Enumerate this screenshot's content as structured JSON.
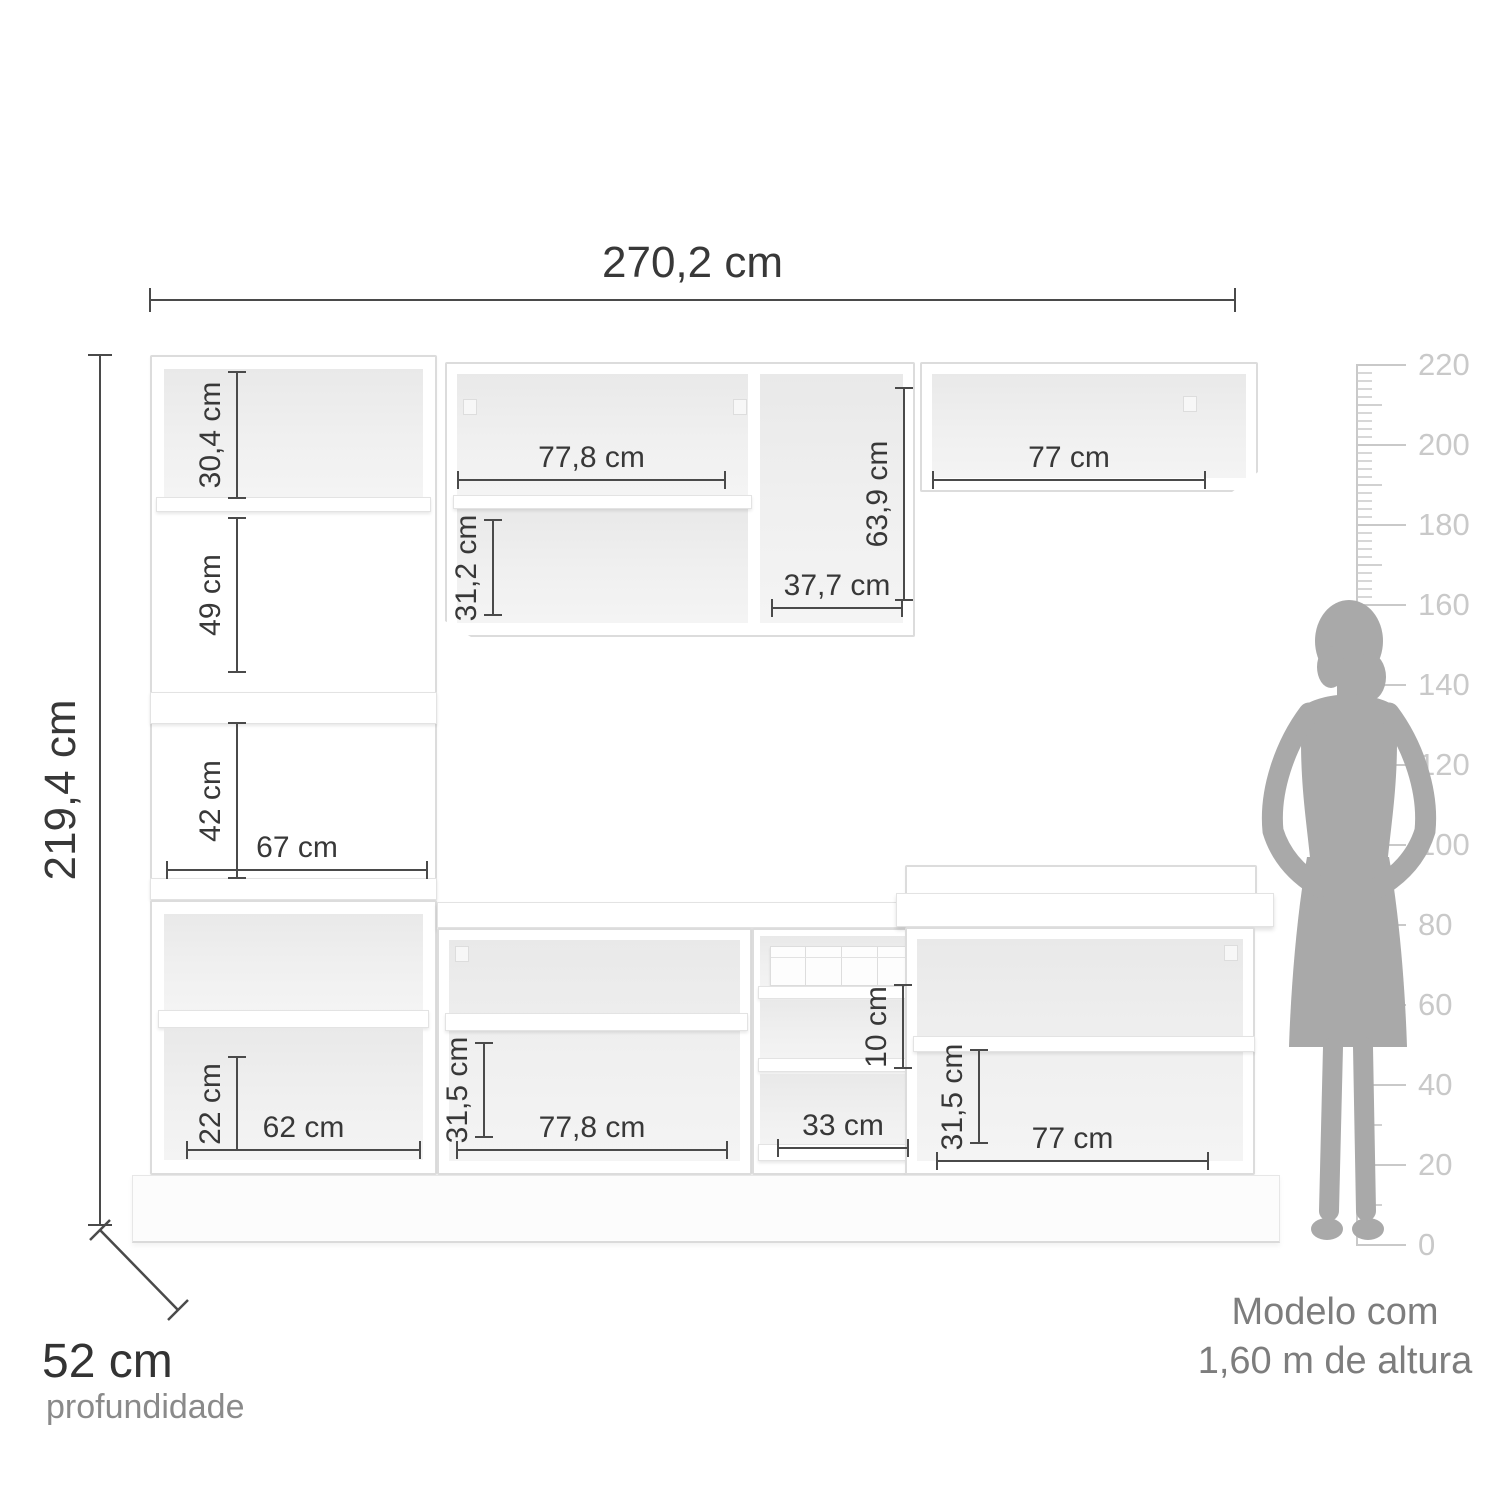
{
  "overall_dimensions": {
    "width": "270,2 cm",
    "height": "219,4 cm",
    "depth": "52 cm",
    "depth_caption": "profundidade"
  },
  "measurements": {
    "tall_cabinet_top_height": "30,4 cm",
    "tall_cabinet_middle_height": "49 cm",
    "tall_cabinet_niche_height": "42 cm",
    "tall_cabinet_niche_width": "67 cm",
    "wall_cabinet_width": "77,8 cm",
    "wall_cabinet_lower_height": "31,2 cm",
    "wall_cabinet_door_height": "63,9 cm",
    "wall_cabinet_door_width": "37,7 cm",
    "wall_cabinet_right_width": "77 cm",
    "base_left_drawer_height": "22 cm",
    "base_left_width": "62 cm",
    "base_middle_height": "31,5 cm",
    "base_middle_width": "77,8 cm",
    "drawer_height": "10 cm",
    "drawer_width": "33 cm",
    "base_right_height": "31,5 cm",
    "base_right_width": "77 cm"
  },
  "ruler": {
    "unit": "cm",
    "min": 0,
    "max": 220,
    "step": 20,
    "labels": [
      "220",
      "200",
      "180",
      "160",
      "140",
      "120",
      "100",
      "80",
      "60",
      "40",
      "20",
      "0"
    ]
  },
  "model": {
    "caption_line1": "Modelo com",
    "caption_line2": "1,60 m de altura"
  },
  "colors": {
    "dimension_line": "#4a4a4a",
    "dimension_text": "#383838",
    "ruler": "#c9c9c9",
    "silhouette": "#a9a9a9",
    "caption_text": "#7d7d7d",
    "cabinet_edge": "#dcdcdc"
  }
}
